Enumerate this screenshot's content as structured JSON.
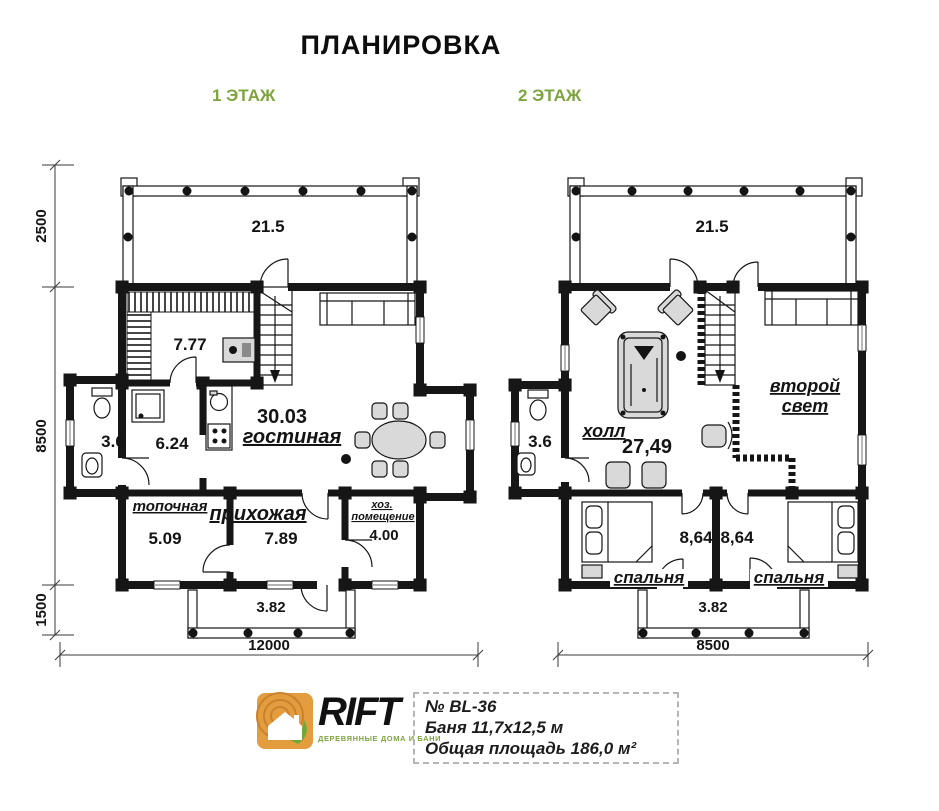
{
  "page": {
    "title": "ПЛАНИРОВКА"
  },
  "colors": {
    "accent_green": "#7ea43e",
    "logo_orange": "#e49d3e",
    "leaf_green": "#71a838"
  },
  "floor1": {
    "label": "1 ЭТАЖ",
    "terrace_area": "21.5",
    "sauna_area": "7.77",
    "living": {
      "area": "30.03",
      "name": "гостиная"
    },
    "bathroom_area": "3.6",
    "shower_area": "6.24",
    "furnace": {
      "name": "топочная",
      "area": "5.09"
    },
    "hallway": {
      "name": "прихожая",
      "area": "7.89"
    },
    "utility": {
      "name_line1": "хоз.",
      "name_line2": "помещение",
      "area": "4.00"
    },
    "porch_area": "3.82",
    "dims": {
      "left_top": "2500",
      "left_mid": "8500",
      "left_bottom": "1500",
      "width": "12000"
    }
  },
  "floor2": {
    "label": "2 ЭТАЖ",
    "terrace_area": "21.5",
    "hall": {
      "name": "холл",
      "area": "27,49"
    },
    "second_light": {
      "line1": "второй",
      "line2": "свет"
    },
    "bathroom_area": "3.6",
    "bedroom_left": {
      "name": "спальня",
      "area": "8,64"
    },
    "bedroom_right": {
      "name": "спальня",
      "area": "8,64"
    },
    "balcony_area": "3.82",
    "dims": {
      "width": "8500"
    }
  },
  "footer": {
    "brand": "RIFT",
    "tagline": "ДЕРЕВЯННЫЕ ДОМА И БАНИ",
    "model": "№ BL-36",
    "size": "Баня 11,7х12,5 м",
    "total_area": "Общая площадь 186,0 м²"
  }
}
